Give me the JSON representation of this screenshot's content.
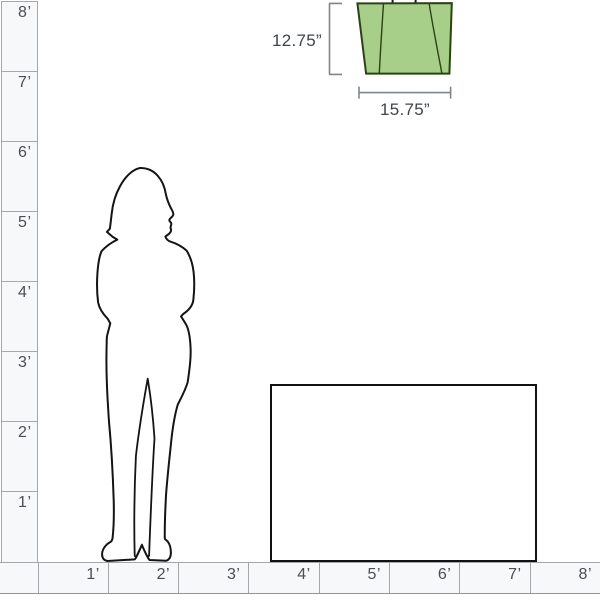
{
  "vertical_ruler": {
    "unit": "feet",
    "labels": [
      "8’",
      "7’",
      "6’",
      "5’",
      "4’",
      "3’",
      "2’",
      "1’"
    ]
  },
  "horizontal_ruler": {
    "unit": "feet",
    "labels": [
      "1’",
      "2’",
      "3’",
      "4’",
      "5’",
      "6’",
      "7’",
      "8’"
    ]
  },
  "product": {
    "height_label": "12.75”",
    "width_label": "15.75”",
    "shade_color": "#a7cf89",
    "outline_color": "#2b4313"
  },
  "reference": {
    "person_icon": "woman-silhouette",
    "furniture_icon": "table-outline"
  },
  "colors": {
    "ruler_line": "#a3a8ab",
    "ruler_text": "#4a4e54",
    "dimension_line": "#7e858c",
    "dimension_text": "#3f444a",
    "figure_outline": "#141414"
  }
}
